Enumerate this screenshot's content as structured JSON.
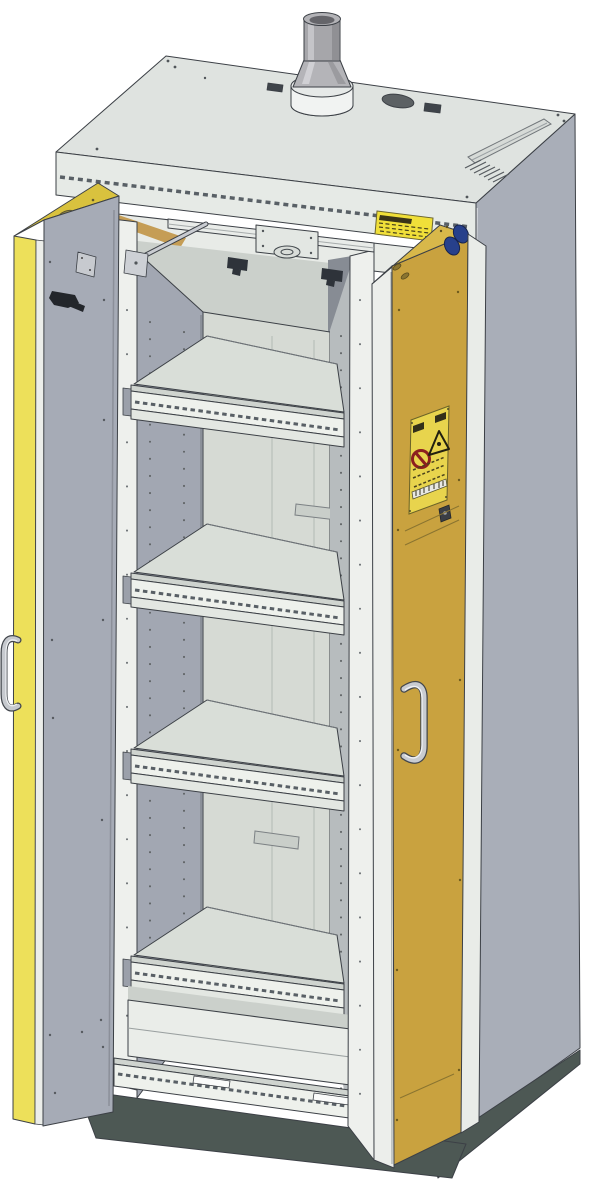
{
  "meta": {
    "description": "Technical CAD illustration of a tall type-90 safety storage cabinet with both wing doors open, a roof exhaust air connector, four pull-out shelf trays, a bottom collecting sump and a dark plinth base",
    "style": "isometric technical line drawing",
    "canvas": {
      "width": 600,
      "height": 1183
    }
  },
  "colors": {
    "background": "#ffffff",
    "outline": "#3c4046",
    "body_light": "#dfe3e0",
    "fascia": "#e6eae6",
    "beam": "#e8ebe7",
    "side_grey": "#a9aeb8",
    "interior_wall": "#a2a7b2",
    "right_wall": "#b7bcbe",
    "back_wall": "#d6dad4",
    "ceiling": "#cbd0cb",
    "shelf_floor": "#d9ded8",
    "rail_white": "#eef1ec",
    "rail_top": "#cfd4cf",
    "sump_face": "#eaede9",
    "door_yellow": "#ede05a",
    "door_yellow_cap": "#d9c23e",
    "door_inner_grey": "#a6abb6",
    "door_gold": "#c9a23f",
    "door_gold_cap": "#d8b84a",
    "door_edge_white": "#eceeeb",
    "base_dark": "#4d5854",
    "metal_grey": "#a6a6aa",
    "metal_light": "#c9ccd1",
    "blue_disc": "#27408b",
    "label_yellow": "#e8d44d",
    "sticker_yellow": "#f0df39",
    "prohibition_red": "#8c1f1f",
    "insulation_tan": "#c59d55"
  },
  "components": {
    "exhaust_connector": {
      "name": "exhaust air connector",
      "location": "roof, centre"
    },
    "roof": {
      "features": [
        "blanked-port-hole",
        "ventilation-grille",
        "recessed-cover-plate",
        "screw-heads"
      ]
    },
    "doors": {
      "left": {
        "state": "open",
        "front_color_name": "safety yellow",
        "inner_color_name": "grey",
        "parts": [
          "door-handle",
          "door-closer",
          "coordinator-rod-bracket"
        ]
      },
      "right": {
        "state": "open",
        "inner_color_name": "ochre yellow",
        "parts": [
          "door-handle",
          "hazard-label",
          "lock-keyhole",
          "blue-stop-discs"
        ]
      }
    },
    "door_coordinator": {
      "name": "door closing-sequence mechanism",
      "location": "interior top, under roof"
    },
    "interior": {
      "shelf_count": 4,
      "shelves": [
        {
          "index": 1
        },
        {
          "index": 2
        },
        {
          "index": 3
        },
        {
          "index": 4
        }
      ],
      "sump": {
        "name": "bottom collecting sump"
      },
      "walls": "perforated shelf height-adjustment hole rows"
    },
    "base": {
      "name": "plinth base",
      "color_name": "dark grey"
    },
    "labels": {
      "interior_top_sticker": {
        "type": "warning sticker",
        "icons": [
          "warning-triangle-icon"
        ],
        "text_legible": false
      },
      "door_hazard_label": {
        "type": "hazard sticker",
        "icons": [
          "no-open-flames-prohibition-icon",
          "flammable-warning-triangle-icon",
          "barcode"
        ],
        "text_legible": false
      }
    }
  },
  "shelf_front_rail_y": [
    390,
    578,
    754,
    961
  ]
}
